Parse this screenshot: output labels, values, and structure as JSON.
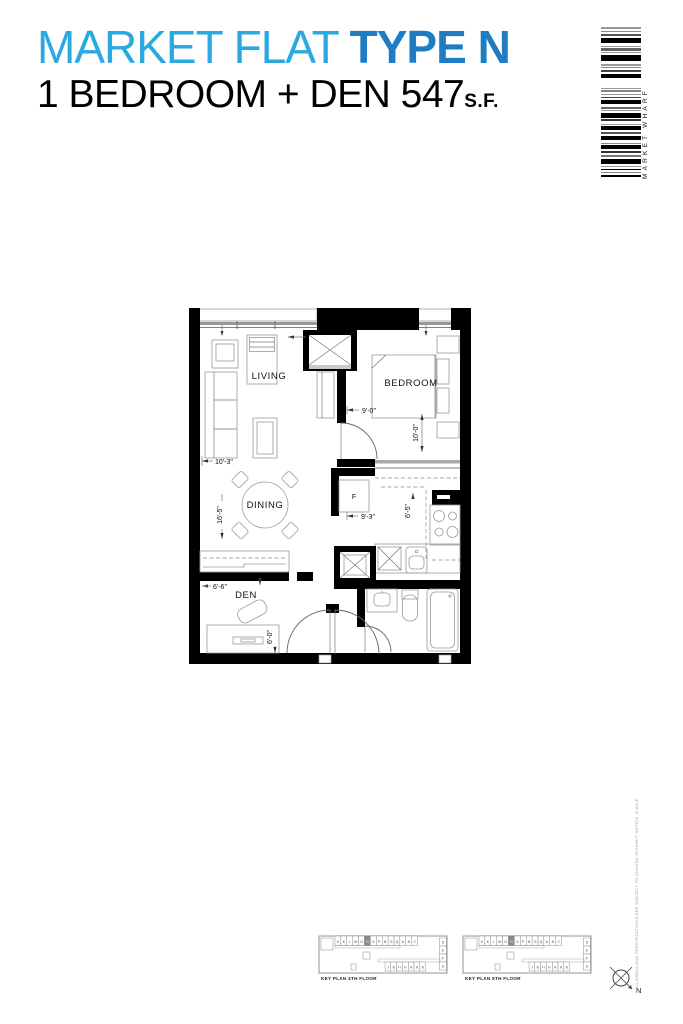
{
  "header": {
    "title_light": "MARKET FLAT ",
    "title_bold": "TYPE N",
    "subtitle": "1 BEDROOM + DEN 547",
    "subtitle_suffix": "S.F.",
    "accent_light": "#2AA9E0",
    "accent_dark": "#1E7DC2"
  },
  "brand": {
    "vertical_text": "MARKET WHARF"
  },
  "barcode": {
    "stripes": [
      [
        2,
        2,
        "#999"
      ],
      [
        1,
        2,
        "#888"
      ],
      [
        1.5,
        2,
        "#555"
      ],
      [
        5,
        3,
        "#000"
      ],
      [
        1,
        1.5,
        "#999"
      ],
      [
        2.5,
        1.5,
        "#666"
      ],
      [
        1,
        2,
        "#999"
      ],
      [
        6,
        3,
        "#000"
      ],
      [
        1.5,
        1.5,
        "#999"
      ],
      [
        1,
        2,
        "#888"
      ],
      [
        2,
        1.5,
        "#444"
      ],
      [
        4,
        10,
        "#000"
      ],
      [
        1,
        1.5,
        "#999"
      ],
      [
        2,
        1.5,
        "#888"
      ],
      [
        1,
        2,
        "#999"
      ],
      [
        1.5,
        2,
        "#444"
      ],
      [
        4,
        2.5,
        "#000"
      ],
      [
        2,
        1.5,
        "#666"
      ],
      [
        1,
        1.5,
        "#999"
      ],
      [
        5,
        1.5,
        "#000"
      ],
      [
        2,
        2.5,
        "#333"
      ],
      [
        1,
        1.5,
        "#999"
      ],
      [
        4,
        2,
        "#000"
      ],
      [
        1.5,
        2,
        "#555"
      ],
      [
        4,
        3,
        "#000"
      ],
      [
        1,
        1.5,
        "#888"
      ],
      [
        4,
        2,
        "#000"
      ],
      [
        2,
        2,
        "#333"
      ],
      [
        1.5,
        2,
        "#777"
      ],
      [
        5,
        2,
        "#000"
      ],
      [
        1,
        2,
        "#999"
      ],
      [
        1.5,
        1.5,
        "#000"
      ],
      [
        1,
        2,
        "#888"
      ],
      [
        2,
        0,
        "#000"
      ]
    ]
  },
  "floor_plan": {
    "rooms": {
      "living": "LIVING",
      "bedroom": "BEDROOM",
      "dining": "DINING",
      "den": "DEN",
      "fridge": "F"
    },
    "dims": {
      "door_9_0": "9'-0\"",
      "bed_10_0": "10'-0\"",
      "living_10_3": "10'-3\"",
      "hall_9_3": "9'-3\"",
      "kitchen_6_5": "6'-5\"",
      "dining_16_5": "16'-5\"",
      "den_6_6": "6'-6\"",
      "den_6_0": "6'-0\""
    }
  },
  "key_plans": [
    {
      "label": "KEY PLAN 4TH FLOOR",
      "top_units": [
        "K",
        "K",
        "L",
        "M",
        "O",
        "N",
        "S",
        "P",
        "B",
        "O",
        "Q",
        "A",
        "B",
        "C"
      ],
      "highlight_index": 5,
      "right_units": [
        "D",
        "E",
        "F",
        "G"
      ],
      "wing_units": [
        "J",
        "B",
        "H",
        "H",
        "H",
        "H",
        "B"
      ]
    },
    {
      "label": "KEY PLAN 5TH FLOOR",
      "top_units": [
        "K",
        "K",
        "L",
        "M",
        "O",
        "N",
        "S",
        "P",
        "B",
        "O",
        "Q",
        "A",
        "B",
        "C"
      ],
      "highlight_index": 5,
      "right_units": [
        "D",
        "E",
        "F",
        "G"
      ],
      "wing_units": [
        "J",
        "B",
        "H",
        "H",
        "H",
        "H",
        "B"
      ]
    }
  ],
  "compass": {
    "label": "N"
  },
  "disclaimer": "ALL AREAS AND SPECIFICATIONS ARE SUBJECT TO CHANGE WITHOUT NOTICE. E.&O.E."
}
